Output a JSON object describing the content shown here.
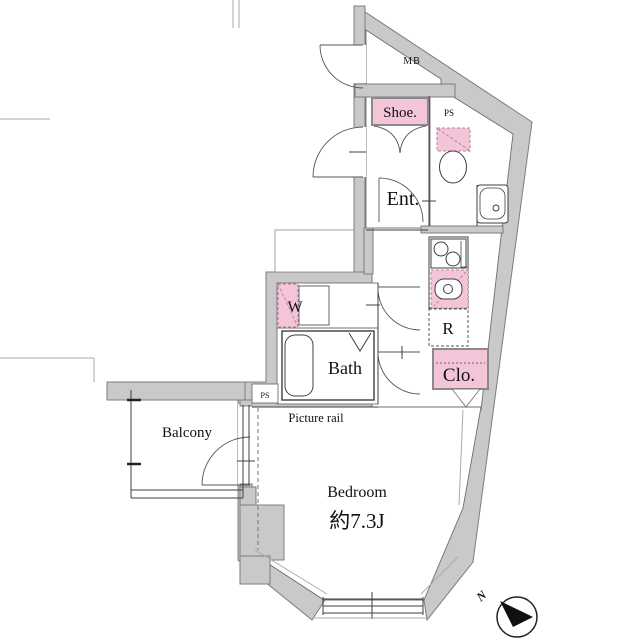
{
  "colors": {
    "accent_pink": "#f4c4d8",
    "wall_gray": "#c9c9c9",
    "line_dark": "#3f3f3f"
  },
  "rooms": {
    "mb": {
      "label": "MB"
    },
    "ps_upper": {
      "label": "PS"
    },
    "shoe": {
      "label": "Shoe."
    },
    "entrance": {
      "label": "Ent."
    },
    "washer": {
      "label": "W"
    },
    "bath": {
      "label": "Bath"
    },
    "refrigerator": {
      "label": "R"
    },
    "closet": {
      "label": "Clo."
    },
    "ps_lower": {
      "label": "PS"
    },
    "picture_rail": {
      "label": "Picture rail"
    },
    "balcony": {
      "label": "Balcony"
    },
    "bedroom": {
      "label": "Bedroom",
      "size_label": "約7.3J"
    }
  },
  "compass": {
    "label": "N"
  }
}
